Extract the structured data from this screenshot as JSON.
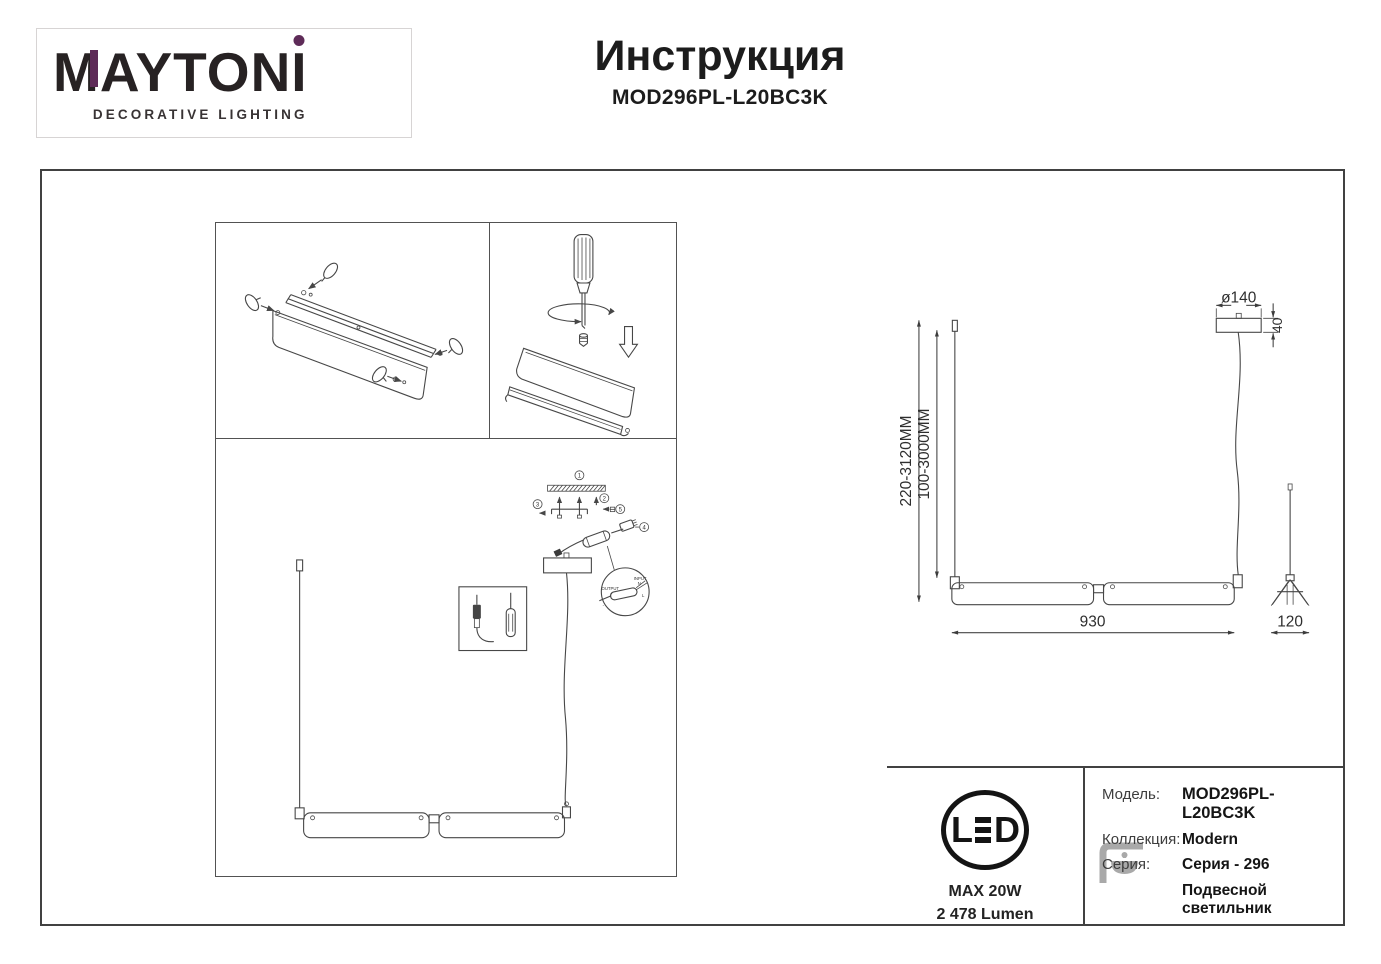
{
  "header": {
    "brand": {
      "m": "M",
      "mid": "AYTON",
      "i": "I",
      "tagline": "DECORATIVE LIGHTING",
      "accent": "#5e2b58",
      "ink": "#272223"
    },
    "title": "Инструкция",
    "model": "MOD296PL-L20BC3K"
  },
  "assembly": {
    "callout_1": "1",
    "callout_2": "2",
    "callout_3": "3",
    "callout_4": "4",
    "callout_5": "5",
    "wiring": {
      "input": "INPUT",
      "n": "N",
      "l": "L",
      "output": "OUTPUT",
      "plus": "+",
      "minus": "-"
    }
  },
  "dimensions": {
    "suspension_full": "220-3120MM",
    "suspension_cable": "100-3000MM",
    "canopy_diameter": "ø140",
    "canopy_height": "40",
    "fixture_length": "930",
    "fixture_width": "120"
  },
  "specs": {
    "led_l": "L",
    "led_d": "D",
    "max_power": "MAX 20W",
    "luminous_flux": "2 478 Lumen",
    "model_label": "Модель:",
    "model_value": "MOD296PL-L20BC3K",
    "collection_label": "Коллекция:",
    "collection_value": "Modern",
    "series_label": "Серия:",
    "series_value": "Серия - 296",
    "type_value": "Подвесной светильник"
  }
}
